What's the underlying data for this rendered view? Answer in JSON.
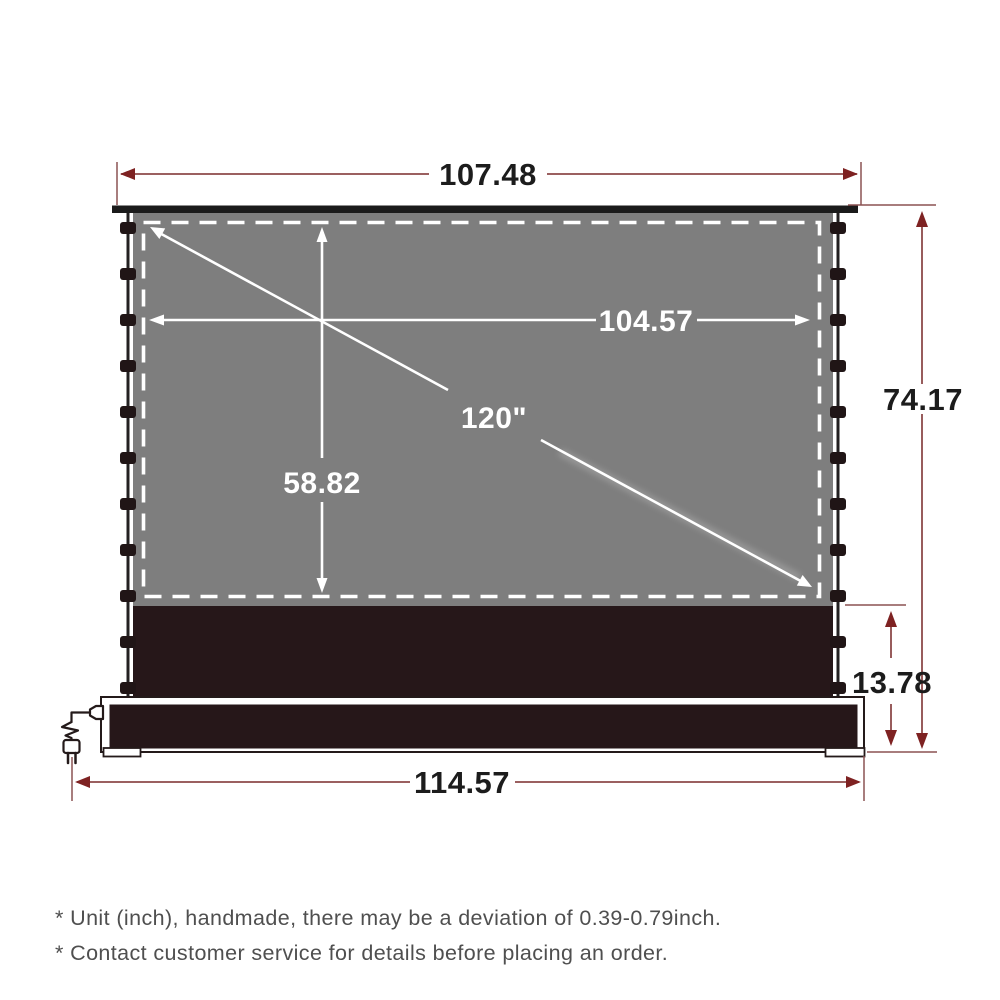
{
  "product": "floor-rising-projector-screen-dimension-diagram",
  "dimensions": {
    "top_width": "107.48",
    "viewing_width": "104.57",
    "viewing_height": "58.82",
    "diagonal": "120\"",
    "total_height": "74.17",
    "base_height": "13.78",
    "base_width": "114.57"
  },
  "notes": {
    "line1": "* Unit (inch), handmade, there may be a deviation of 0.39-0.79inch.",
    "line2": "* Contact customer service for details before placing an order."
  },
  "icons": {
    "power_plug": "power-plug-icon"
  },
  "colors": {
    "dimension_line": "#8d4a4a",
    "dimension_arrow": "#7e2222",
    "dimension_text": "#1c1c1c",
    "screen_gray": "#7e7e7e",
    "housing_dark": "#261719",
    "frame_black": "#1b1b1b",
    "tab": "#201516",
    "dashed_border": "#ffffff",
    "note_text": "#4f4f4f",
    "background": "#ffffff"
  },
  "layout": {
    "tab_count_per_side": 11
  }
}
